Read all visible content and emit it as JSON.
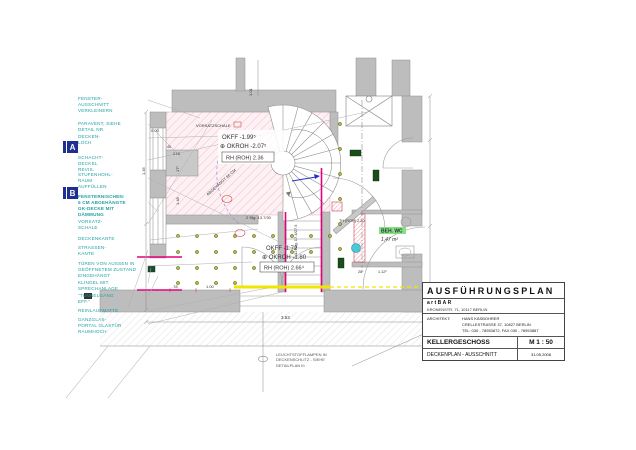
{
  "title_block": {
    "title": "AUSFÜHRUNGSPLAN",
    "project": "artBAR",
    "project_address": "KRONENSTR. 71, 10117 BERLIN",
    "architect_label": "ARCHITEKT:",
    "architect_name": "HANS KÄSBOHRER",
    "architect_address": "CRELLESTRASSE 37, 10827 BERLIN",
    "architect_phone": "TEL: 030 - 78953872, FAX 030 - 78953887",
    "floor": "KELLERGESCHOSS",
    "scale": "M 1 : 50",
    "plan_type": "DECKENPLAN - AUSSCHNITT",
    "date": "31.05.2008"
  },
  "section_markers": {
    "a": "A",
    "b": "B"
  },
  "side_labels": [
    {
      "id": "fenster",
      "text": "FENSTER-\nAUSSCHNITT\nVERKLEINERN"
    },
    {
      "id": "paravent",
      "text": "PARAVENT, SIEHE\nDETAIL NR."
    },
    {
      "id": "deckenloch",
      "text": "DECKEN-\nLOCH"
    },
    {
      "id": "schachtdeckel",
      "text": "SCHACHT-\nDECKEL\nREVIS."
    },
    {
      "id": "stufenhohlraum",
      "text": "STUFENHOHL-\nRAUM\nAUFFÜLLEN"
    },
    {
      "id": "fensternischen",
      "text": "FENSTERNISCHEN:\n5 CM ABGEHÄNGTE\nGK-DECKE MIT\nDÄMMUNG"
    },
    {
      "id": "vorsatzschale",
      "text": "VORSATZ-\nSCHALE"
    },
    {
      "id": "deckenkante",
      "text": "DECKENKANTE"
    },
    {
      "id": "strassenkante",
      "text": "STRASSEN-\nKANTE"
    },
    {
      "id": "tueren",
      "text": "TÜREN VON AUSSEN IN\nGEÖFFNETEM ZUSTAND\nEINGEHÄNGT"
    },
    {
      "id": "klingel",
      "text": "KLINGEL MIT\nSPRECHANLAGE"
    },
    {
      "id": "tunnelgang",
      "text": "\"TUNNELGANG\nEFF.\""
    },
    {
      "id": "reinlaufmatte",
      "text": "REINLAUFMATTE"
    },
    {
      "id": "ganzglas",
      "text": "GANZGLAS-\nPORTAL GLASTÜR\nRAUMHOCH"
    }
  ],
  "plan": {
    "rooms": {
      "upper": {
        "okff": "OKFF  -1.99⁵",
        "okroh": "⊕ OKROH -2.07⁵",
        "rh": "RH (ROH) 2.36"
      },
      "lower": {
        "okff": "OKFF  -1.72",
        "okroh": "⊕ OKROH -1.80",
        "rh": "RH (ROH) 2.66⁴"
      },
      "wc": {
        "name": "BEH. WC",
        "area": "1,47 m²"
      }
    },
    "stair": {
      "straight": "2 Stg. 13.7/30",
      "spiral": "12 Stg. 17.4/27.5"
    },
    "notes": {
      "vorsatzschale": "VORSATZSCHALE",
      "abhang": "ABGEHÄNGT 96 CM",
      "door_height": "TH (ROH) 2.20",
      "lamps": "LEUCHTSTOFFLAMPEN IN\nDECKENSCHLITZ - SIEHE\nDETAILPLAN III"
    },
    "dimensions": {
      "d000": "0.00",
      "d101": "1.01",
      "d45": "45",
      "d215": "2.15",
      "d78": ".78",
      "d100": "1.00",
      "d353": "3.53",
      "d281": "28¹",
      "d112": "1.12²",
      "d145": "1.45",
      "d148": "1.48",
      "d175": "17⁵"
    }
  },
  "colors": {
    "label_teal": "#1f9fa4",
    "marker_blue": "#1d2f93",
    "highlight_magenta": "#e6007e",
    "highlight_yellow": "#f2e500",
    "hatch_pink": "#e8a0b4",
    "wall_gray": "#bdbdbd",
    "lamp_green": "#b5b933",
    "wc_green": "#86e086"
  }
}
